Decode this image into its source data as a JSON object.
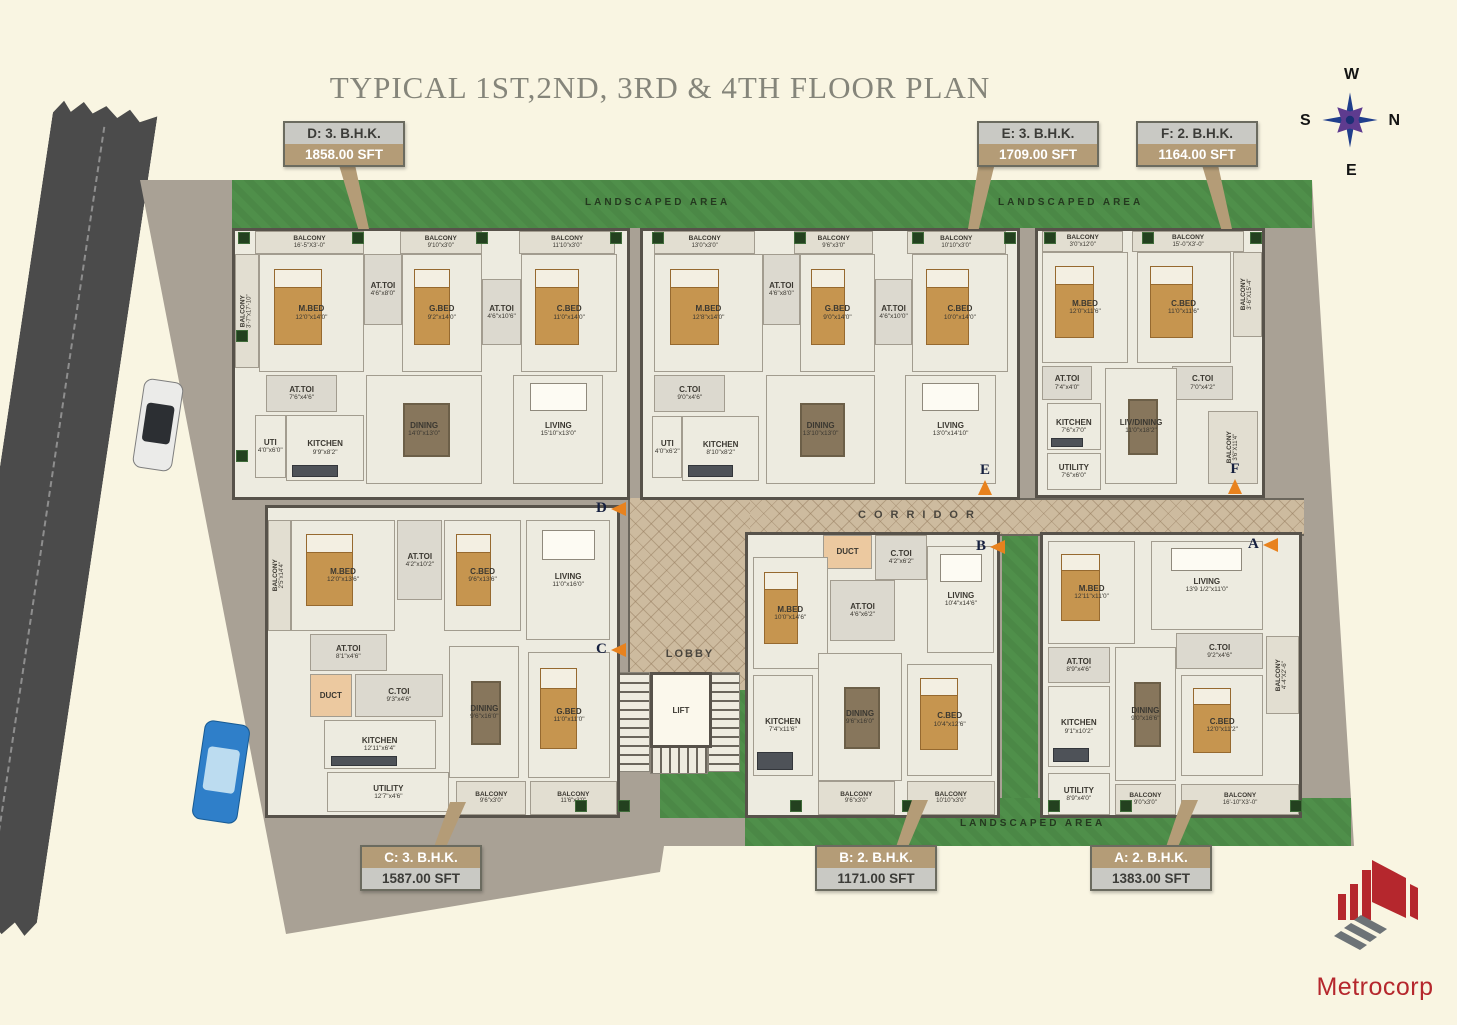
{
  "title": "TYPICAL 1ST,2ND, 3RD & 4TH FLOOR PLAN",
  "brand": {
    "name": "Metrocorp"
  },
  "compass": {
    "top": "W",
    "left": "S",
    "right": "N",
    "bottom": "E"
  },
  "labels": {
    "corridor": "CORRIDOR",
    "lobby": "LOBBY",
    "lift": "LIFT"
  },
  "landscape": {
    "top_left": "LANDSCAPED AREA",
    "top_right": "LANDSCAPED AREA",
    "bottom": "LANDSCAPED AREA"
  },
  "callouts": [
    {
      "letter": "D",
      "title": "D: 3. B.H.K.",
      "area": "1858.00 SFT"
    },
    {
      "letter": "E",
      "title": "E: 3. B.H.K.",
      "area": "1709.00 SFT"
    },
    {
      "letter": "F",
      "title": "F: 2. B.H.K.",
      "area": "1164.00 SFT"
    },
    {
      "letter": "C",
      "title": "C: 3. B.H.K.",
      "area": "1587.00 SFT"
    },
    {
      "letter": "B",
      "title": "B: 2. B.H.K.",
      "area": "1171.00 SFT"
    },
    {
      "letter": "A",
      "title": "A: 2. B.H.K.",
      "area": "1383.00 SFT"
    }
  ],
  "unit_markers": [
    "D",
    "E",
    "F",
    "C",
    "B",
    "A"
  ],
  "units": {
    "D": {
      "rooms": [
        {
          "name": "BALCONY",
          "dim": "16'-5\"X3'-0\""
        },
        {
          "name": "BALCONY",
          "dim": "9'10\"x3'0\""
        },
        {
          "name": "BALCONY",
          "dim": "11'10\"x3'0\""
        },
        {
          "name": "BALCONY",
          "dim": "3'-7\"x17'-10\""
        },
        {
          "name": "M.BED",
          "dim": "12'0\"x14'0\""
        },
        {
          "name": "AT.TOI",
          "dim": "4'6\"x8'0\""
        },
        {
          "name": "G.BED",
          "dim": "9'2\"x14'0\""
        },
        {
          "name": "AT.TOI",
          "dim": "4'6\"x10'6\""
        },
        {
          "name": "C.BED",
          "dim": "11'0\"x14'0\""
        },
        {
          "name": "AT.TOI",
          "dim": "7'6\"x4'6\""
        },
        {
          "name": "UTI",
          "dim": "4'0\"x6'0\""
        },
        {
          "name": "KITCHEN",
          "dim": "9'9\"x8'2\""
        },
        {
          "name": "DINING",
          "dim": "14'0\"x13'0\""
        },
        {
          "name": "LIVING",
          "dim": "15'10\"x13'0\""
        }
      ]
    },
    "E": {
      "rooms": [
        {
          "name": "BALCONY",
          "dim": "13'0\"x3'0\""
        },
        {
          "name": "BALCONY",
          "dim": "9'6\"x3'0\""
        },
        {
          "name": "BALCONY",
          "dim": "10'10\"x3'0\""
        },
        {
          "name": "M.BED",
          "dim": "12'8\"x14'0\""
        },
        {
          "name": "AT.TOI",
          "dim": "4'6\"x8'0\""
        },
        {
          "name": "G.BED",
          "dim": "9'0\"x14'0\""
        },
        {
          "name": "AT.TOI",
          "dim": "4'6\"x10'0\""
        },
        {
          "name": "C.BED",
          "dim": "10'0\"x14'0\""
        },
        {
          "name": "C.TOI",
          "dim": "9'0\"x4'6\""
        },
        {
          "name": "UTI",
          "dim": "4'0\"x6'2\""
        },
        {
          "name": "KITCHEN",
          "dim": "8'10\"x8'2\""
        },
        {
          "name": "DINING",
          "dim": "13'10\"x13'0\""
        },
        {
          "name": "LIVING",
          "dim": "13'0\"x14'10\""
        }
      ]
    },
    "F": {
      "rooms": [
        {
          "name": "BALCONY",
          "dim": "3'0\"x12'0\""
        },
        {
          "name": "BALCONY",
          "dim": "15'-0\"X3'-0\""
        },
        {
          "name": "BALCONY",
          "dim": "3'-6\"X15'-4\""
        },
        {
          "name": "M.BED",
          "dim": "12'0\"x11'6\""
        },
        {
          "name": "C.BED",
          "dim": "11'0\"x11'6\""
        },
        {
          "name": "AT.TOI",
          "dim": "7'4\"x4'0\""
        },
        {
          "name": "C.TOI",
          "dim": "7'0\"x4'2\""
        },
        {
          "name": "KITCHEN",
          "dim": "7'6\"x7'0\""
        },
        {
          "name": "LIV/DINING",
          "dim": "11'0\"x18'2\""
        },
        {
          "name": "UTILITY",
          "dim": "7'6\"x6'0\""
        },
        {
          "name": "BALCONY",
          "dim": "3'6\"X11'4\""
        }
      ]
    },
    "C": {
      "rooms": [
        {
          "name": "BALCONY",
          "dim": "2'5\"x14'4\""
        },
        {
          "name": "M.BED",
          "dim": "12'0\"x13'6\""
        },
        {
          "name": "AT.TOI",
          "dim": "4'2\"x10'2\""
        },
        {
          "name": "C.BED",
          "dim": "9'6\"x13'6\""
        },
        {
          "name": "LIVING",
          "dim": "11'0\"x16'0\""
        },
        {
          "name": "AT.TOI",
          "dim": "8'1\"x4'6\""
        },
        {
          "name": "DUCT",
          "dim": ""
        },
        {
          "name": "C.TOI",
          "dim": "9'3\"x4'6\""
        },
        {
          "name": "KITCHEN",
          "dim": "12'11\"x6'4\""
        },
        {
          "name": "DINING",
          "dim": "9'6\"x16'0\""
        },
        {
          "name": "UTILITY",
          "dim": "12'7\"x4'6\""
        },
        {
          "name": "BALCONY",
          "dim": "9'6\"x3'0\""
        },
        {
          "name": "G.BED",
          "dim": "11'0\"x11'0\""
        },
        {
          "name": "BALCONY",
          "dim": "11'6\"x3'0\""
        }
      ]
    },
    "B": {
      "rooms": [
        {
          "name": "DUCT",
          "dim": ""
        },
        {
          "name": "C.TOI",
          "dim": "4'2\"x6'2\""
        },
        {
          "name": "AT.TOI",
          "dim": "4'6\"x6'2\""
        },
        {
          "name": "LIVING",
          "dim": "10'4\"x14'6\""
        },
        {
          "name": "M.BED",
          "dim": "10'0\"x14'6\""
        },
        {
          "name": "KITCHEN",
          "dim": "7'4\"x11'6\""
        },
        {
          "name": "DINING",
          "dim": "9'6\"x16'0\""
        },
        {
          "name": "C.BED",
          "dim": "10'4\"x12'6\""
        },
        {
          "name": "BALCONY",
          "dim": "9'6\"x3'0\""
        },
        {
          "name": "BALCONY",
          "dim": "10'10\"x3'0\""
        }
      ]
    },
    "A": {
      "rooms": [
        {
          "name": "M.BED",
          "dim": "12'11\"x11'0\""
        },
        {
          "name": "LIVING",
          "dim": "13'9 1/2\"x11'0\""
        },
        {
          "name": "AT.TOI",
          "dim": "8'9\"x4'6\""
        },
        {
          "name": "C.TOI",
          "dim": "9'2\"x4'6\""
        },
        {
          "name": "KITCHEN",
          "dim": "9'1\"x10'2\""
        },
        {
          "name": "DINING",
          "dim": "9'0\"x16'6\""
        },
        {
          "name": "C.BED",
          "dim": "12'0\"x11'2\""
        },
        {
          "name": "BALCONY",
          "dim": "4'-4\"X2'-6\""
        },
        {
          "name": "UTILITY",
          "dim": "8'9\"x4'0\""
        },
        {
          "name": "BALCONY",
          "dim": "9'0\"x3'0\""
        },
        {
          "name": "BALCONY",
          "dim": "16'-10\"X3'-0\""
        }
      ]
    }
  },
  "colors": {
    "background": "#f9f5e2",
    "grass": "#4f8f4a",
    "road": "#4b4b4b",
    "ground": "#a9a195",
    "callout_tan": "#b49c77",
    "callout_gray": "#c9c9c4",
    "arrow_orange": "#e8821e",
    "brand_red": "#b5272d",
    "title_gray": "#85857a"
  }
}
